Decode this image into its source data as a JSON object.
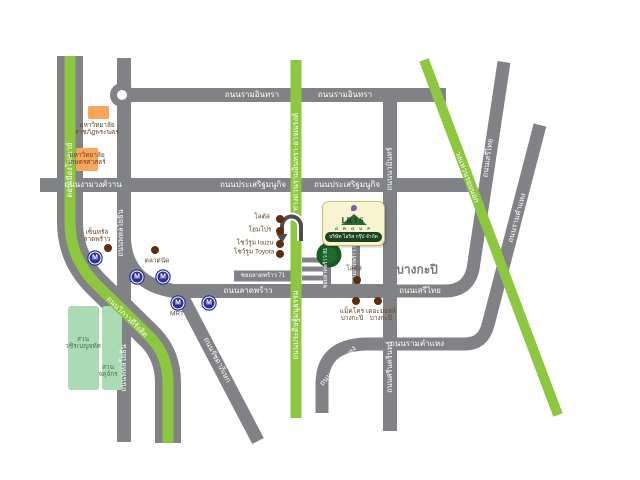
{
  "colors": {
    "road_gray": "#808285",
    "expressway_green": "#8DC63F",
    "university_orange": "#F9A55C",
    "park_green": "#AADBB4",
    "poi_dot_brown": "#5C2E0E",
    "mrt_blue": "#2E3192",
    "poi_label_brown": "#6B4226",
    "district_gray": "#77787B",
    "logo_green": "#1C4220",
    "bubble_cream": "#F9F4D0",
    "project_marker_green": "#175B24"
  },
  "roads": {
    "ram_inthra": "ถนนรามอินทรา",
    "prasert_manukit": "ถนนประเสริฐมนูกิจ",
    "ngamwongwan": "ถนนงามวงศ์วาน",
    "lat_phrao": "ถนนลาดพร้าว",
    "phahonyothin": "ถนนพหลโยธิน",
    "ratchadaphisek": "ถนนรัชดาภิเษก",
    "vibhavadi_rangsit": "ถนนวิภาวดีรังสิต",
    "don_mueang_tollway": "ดอนเมืองโทลเวย์",
    "ramindra_atnarong_expressway": "ทางด่วนรามอินทรา-อาจณรงค์",
    "pradit_manutham": "ถนนประดิษฐ์มนูธรรม",
    "nawamin": "ถนนนวมินทร์",
    "srinagarindra": "ถนนศรีนครินทร์",
    "seri_thai": "ถนนเสรีไทย",
    "ramkhamhaeng": "ถนนรามคำแหง",
    "outer_ring": "วงแหวนรอบนอก",
    "soi_lat_phrao_71": "ซอยลาดพร้าว 71",
    "soi_lat_phrao_81": "ซอยลาดพร้าว 81",
    "soi_lat_phrao_87": "ซอยลาดพร้าว 87"
  },
  "places": {
    "rajabhat_university": {
      "line1": "มหาวิทยาลัย",
      "line2": "ราชภัฏพระนคร"
    },
    "kasetsart_university": {
      "line1": "มหาวิทยาลัย",
      "line2": "เกษตรศาสตร์"
    },
    "central_ladprao": {
      "line1": "เซ็นทรัล",
      "line2": "ลาดพร้าว"
    },
    "market": "ตลาดนัด",
    "lotus_ladprao": "โลตัส",
    "homepro": "โฮมโปร",
    "isuzu_showroom": "โชว์รูม Isuzu",
    "toyota_showroom": "โชว์รูม Toyota",
    "lotus_bangkapi": "โลตัส",
    "makro_bangkapi": {
      "line1": "แม็คโคร",
      "line2": "บางกะปิ"
    },
    "the_mall_bangkapi": {
      "line1": "เดอะมอลล์",
      "line2": "บางกะปิ"
    },
    "bang_kapi_district": "บางกะปิ",
    "vachirabenjatas_park": {
      "line1": "สวน",
      "line2": "วชิรเบญจทัศ"
    },
    "chatuchak_park": {
      "line1": "สวน",
      "line2": "จตุจักร"
    }
  },
  "mrt": {
    "letter": "M",
    "station_label": "MRT"
  },
  "logo": {
    "brand": "IRIS",
    "group": "G R O U P",
    "company": "บริษัท ไอริส กรุ๊ป จำกัด"
  }
}
